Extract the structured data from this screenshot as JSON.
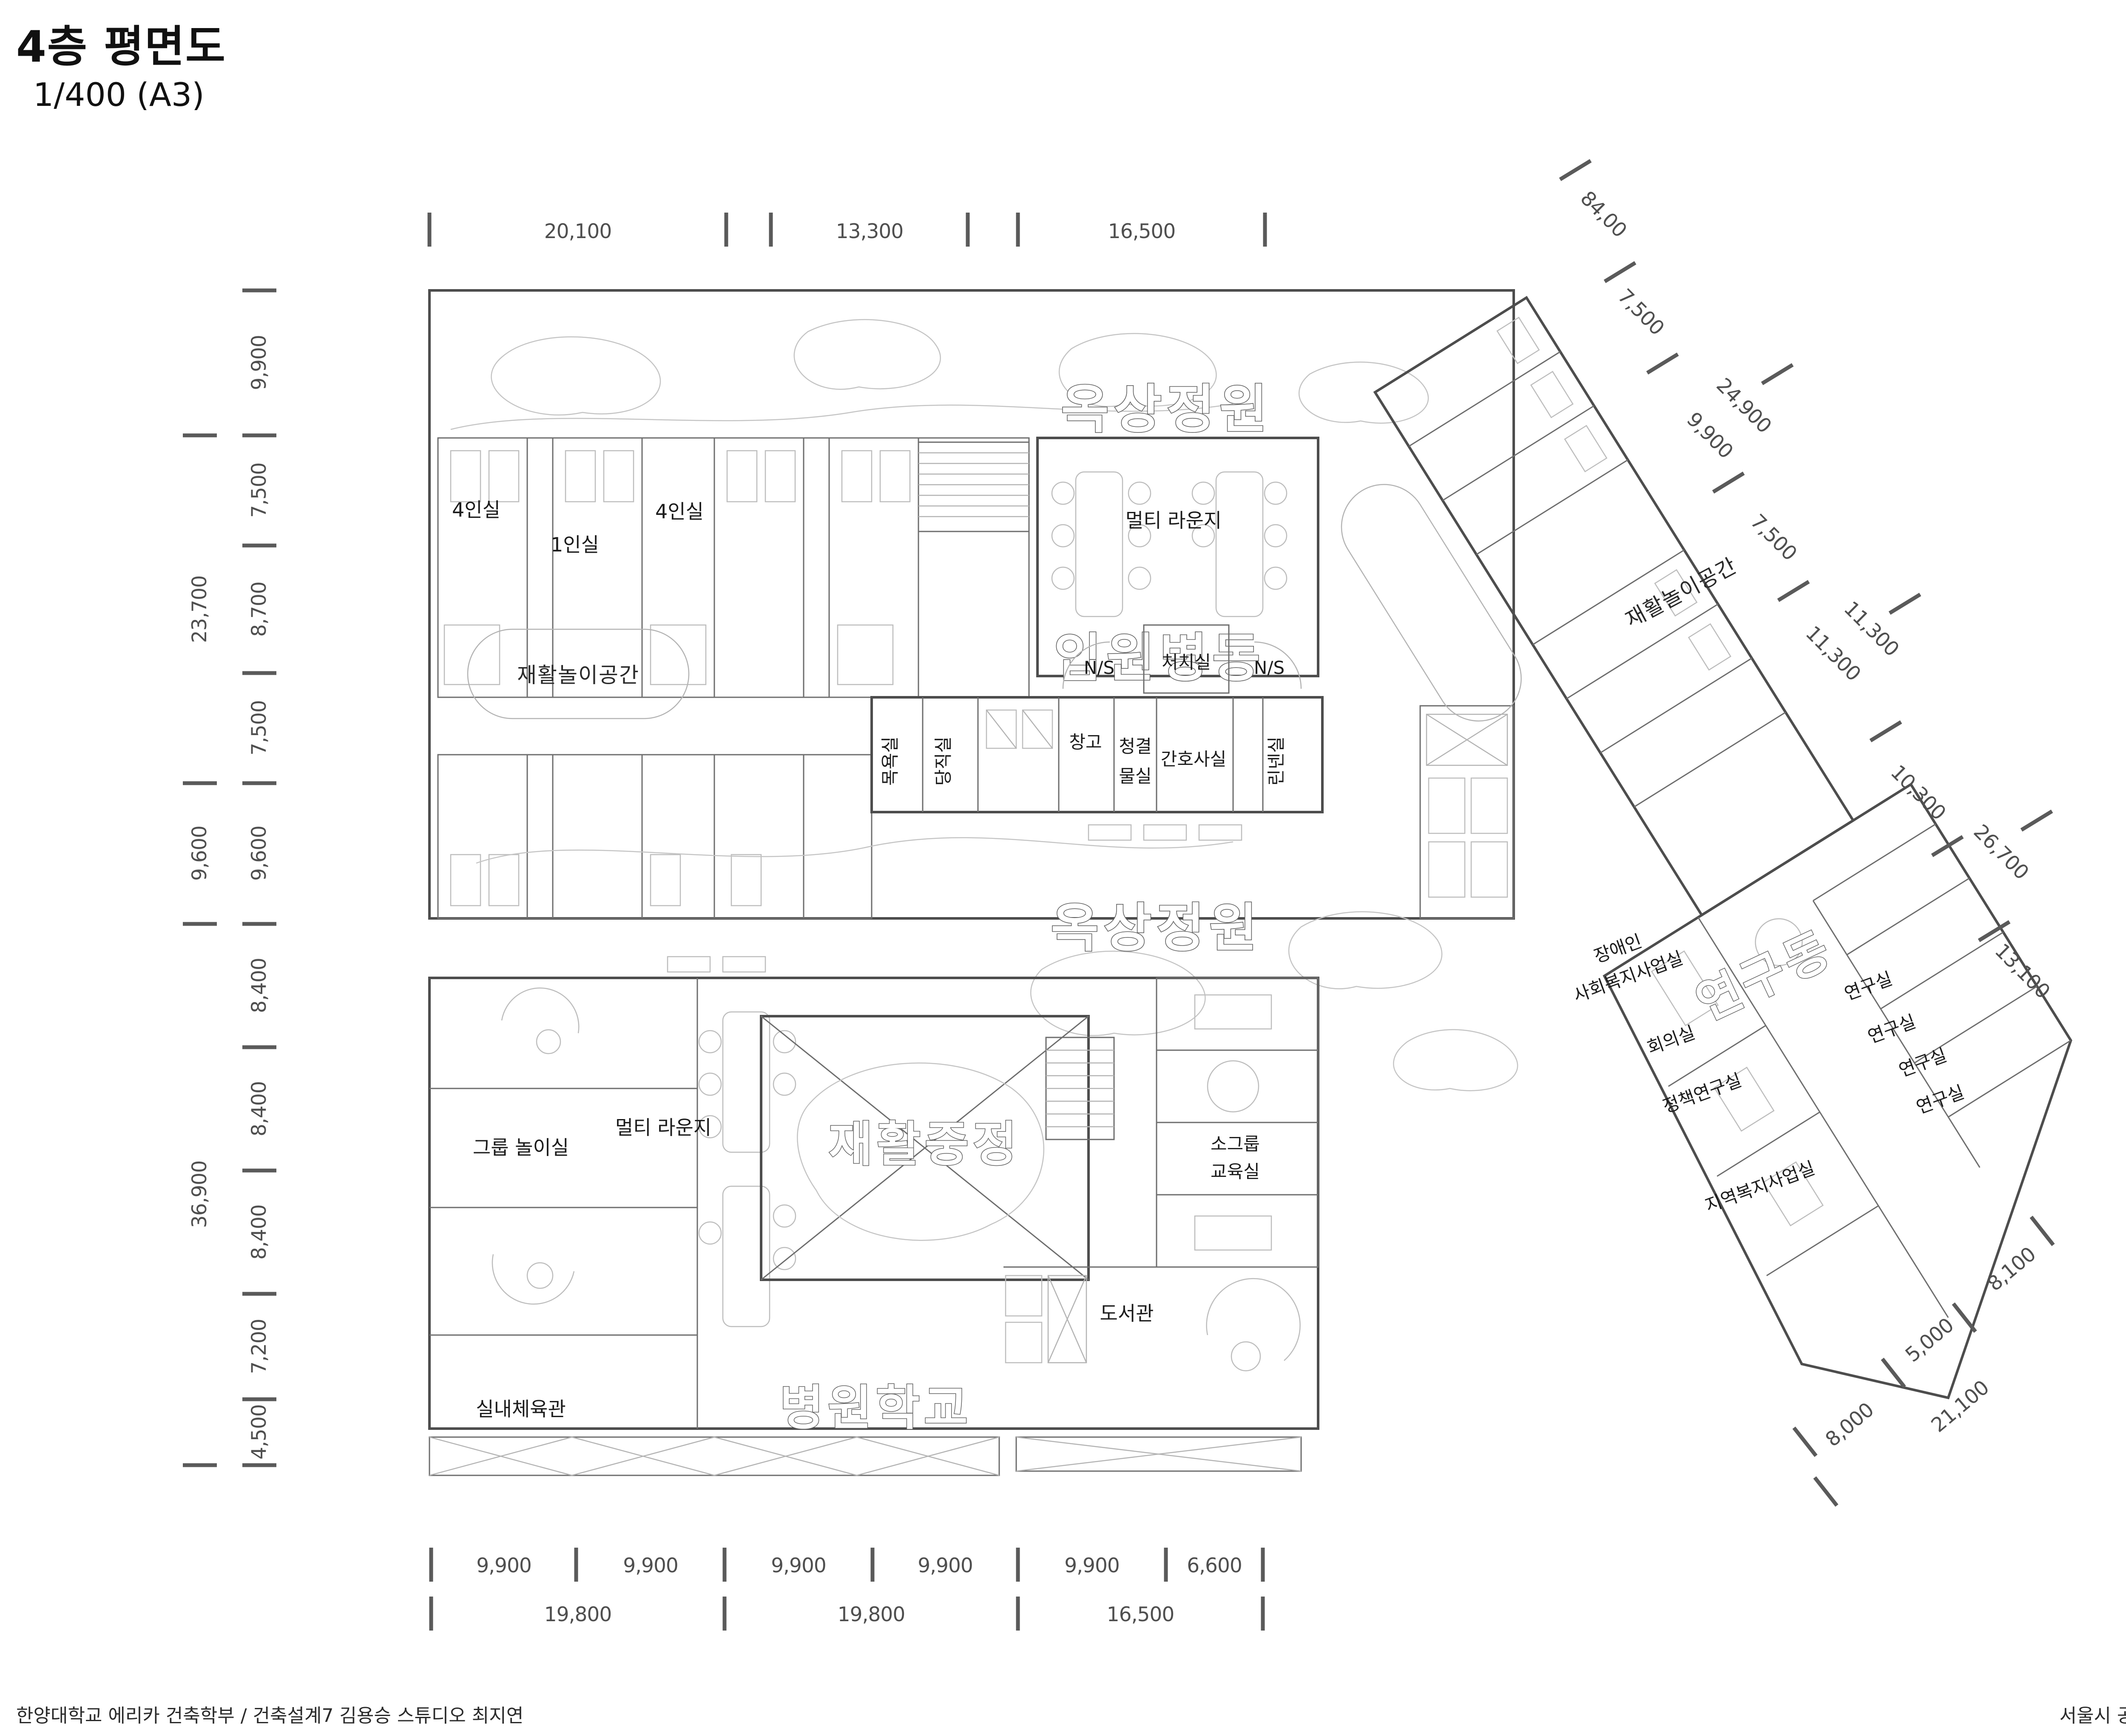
{
  "header": {
    "title": "4층 평면도",
    "scale": "1/400 (A3)"
  },
  "footer": {
    "left": "한양대학교 에리카 건축학부 / 건축설계7 김용승 스튜디오 최지연",
    "right": "서울시 공공 어린이 재활병원. 도담도담 재활병원"
  },
  "icons": {
    "north_indicator": "compass-circle"
  },
  "colors": {
    "wall": "#4d4d4d",
    "dim_text": "#4f4f4f",
    "garden_line": "#c4c4c4",
    "background": "#ffffff"
  },
  "dimensions": {
    "top": [
      "20,100",
      "13,300",
      "16,500"
    ],
    "left_inner": [
      "9,900",
      "7,500",
      "8,700",
      "7,500",
      "9,600",
      "8,400",
      "8,400",
      "8,400",
      "7,200",
      "4,500"
    ],
    "left_outer": [
      "23,700",
      "9,600",
      "36,900"
    ],
    "bottom_inner": [
      "9,900",
      "9,900",
      "9,900",
      "9,900",
      "9,900",
      "6,600"
    ],
    "bottom_outer": [
      "19,800",
      "19,800",
      "16,500"
    ],
    "wing_ne": [
      "84,00",
      "7,500",
      "24,900",
      "9,900",
      "7,500",
      "11,300",
      "11,300",
      "10,300",
      "26,700",
      "13,100"
    ],
    "wing_se": [
      "8,100",
      "5,000",
      "8,000",
      "21,100"
    ]
  },
  "areas": {
    "roof_garden_upper": "옥상정원",
    "roof_garden_middle": "옥상정원",
    "inpatient_ward": "입원병동",
    "rehab_courtyard": "재활중정",
    "hospital_school": "병원학교",
    "research_wing_title": "연구동"
  },
  "rooms": {
    "four_bed_1": "4인실",
    "one_bed": "1인실",
    "four_bed_2": "4인실",
    "multi_lounge_upper": "멀티 라운지",
    "rehab_play_main": "재활놀이공간",
    "rehab_play_wing": "재활놀이공간",
    "ns_left": "N/S",
    "ns_right": "N/S",
    "treatment_room": "처치실",
    "bath_room": "목욕실",
    "duty_room": "당직실",
    "storage": "창고",
    "clean_utility_1": "청결",
    "clean_utility_2": "물실",
    "nurse_office": "간호사실",
    "linen_room": "린넨실",
    "group_play_room": "그룹 놀이실",
    "multi_lounge_lower": "멀티 라운지",
    "small_group_class_1": "소그룹",
    "small_group_class_2": "교육실",
    "indoor_gym": "실내체육관",
    "library": "도서관",
    "disabled_welfare_1": "장애인",
    "disabled_welfare_2": "사회복지사업실",
    "meeting_room": "회의실",
    "policy_research_room": "정책연구실",
    "regional_welfare_room": "지역복지사업실",
    "research_room": "연구실"
  }
}
